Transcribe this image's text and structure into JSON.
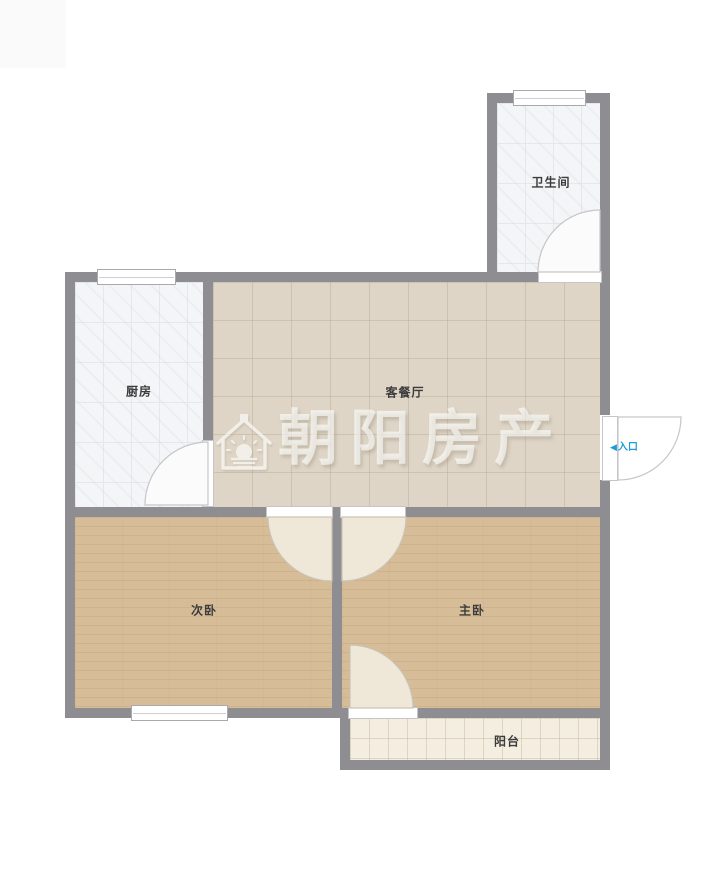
{
  "plan": {
    "rooms": [
      {
        "id": "bathroom",
        "label": "卫生间"
      },
      {
        "id": "kitchen",
        "label": "厨房"
      },
      {
        "id": "living_dining",
        "label": "客餐厅"
      },
      {
        "id": "secondary_bedroom",
        "label": "次卧"
      },
      {
        "id": "master_bedroom",
        "label": "主卧"
      },
      {
        "id": "balcony",
        "label": "阳台"
      }
    ],
    "entrance": {
      "arrow": "◀",
      "label": "入口"
    },
    "watermark": {
      "text": "朝阳房产",
      "logo_icon": "house-sun-logo"
    },
    "colors": {
      "wall": "#8e8e92",
      "tile_light": "#f4f5f7",
      "tile_light_line": "#e4e7eb",
      "living_floor": "#ded5c7",
      "bedroom_floor": "#d6bc97",
      "balcony_floor": "#f4eee1",
      "door_fill_cream": "#efe8d9",
      "label": "#3c3c3c",
      "entrance_accent": "#1f9bd7"
    }
  }
}
